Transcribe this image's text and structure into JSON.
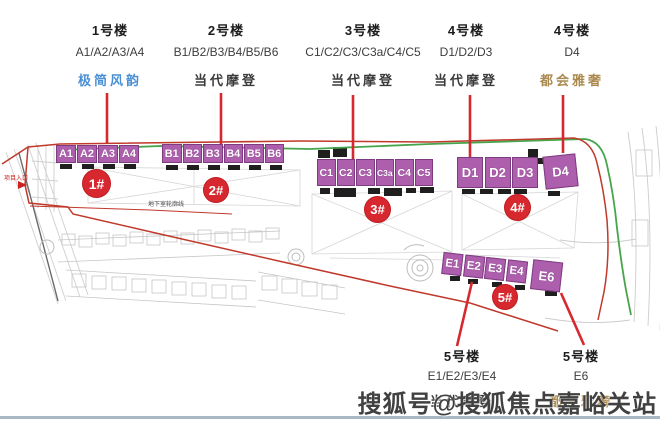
{
  "header_columns": [
    {
      "building": "1号楼",
      "units": "A1/A2/A3/A4",
      "style": "极简风韵",
      "style_color": "#4a8fd4"
    },
    {
      "building": "2号楼",
      "units": "B1/B2/B3/B4/B5/B6",
      "style": "当代摩登",
      "style_color": "#3a3a3a"
    },
    {
      "building": "3号楼",
      "units": "C1/C2/C3/C3a/C4/C5",
      "style": "当代摩登",
      "style_color": "#3a3a3a"
    },
    {
      "building": "4号楼",
      "units": "D1/D2/D3",
      "style": "当代摩登",
      "style_color": "#3a3a3a"
    },
    {
      "building": "4号楼",
      "units": "D4",
      "style": "都会雅奢",
      "style_color": "#ab8a50"
    }
  ],
  "footer_columns": [
    {
      "building": "5号楼",
      "units": "E1/E2/E3/E4",
      "style": "当代摩登",
      "style_color": "#3a3a3a"
    },
    {
      "building": "5号楼",
      "units": "E6",
      "style": "都会雅奢",
      "style_color": "#ab8a50"
    }
  ],
  "site_plan": {
    "building_rows": {
      "A": {
        "badge": "1#",
        "blocks": [
          "A1",
          "A2",
          "A3",
          "A4"
        ]
      },
      "B": {
        "badge": "2#",
        "blocks": [
          "B1",
          "B2",
          "B3",
          "B4",
          "B5",
          "B6"
        ]
      },
      "C": {
        "badge": "3#",
        "blocks": [
          "C1",
          "C2",
          "C3",
          "C3a",
          "C4",
          "C5"
        ]
      },
      "D": {
        "badge": "4#",
        "blocks": [
          "D1",
          "D2",
          "D3",
          "D4"
        ]
      },
      "E": {
        "badge": "5#",
        "blocks": [
          "E1",
          "E2",
          "E3",
          "E4",
          "E6"
        ]
      }
    },
    "annotations": {
      "basement_outline": "地下室轮廓线",
      "entrance": "项目入口"
    },
    "colors": {
      "block_fill": "#ad5fad",
      "badge_red": "#d7282f",
      "boundary_red": "#c0392b",
      "green_line": "#46a44b"
    }
  },
  "watermark": "搜狐号@搜狐焦点嘉峪关站"
}
